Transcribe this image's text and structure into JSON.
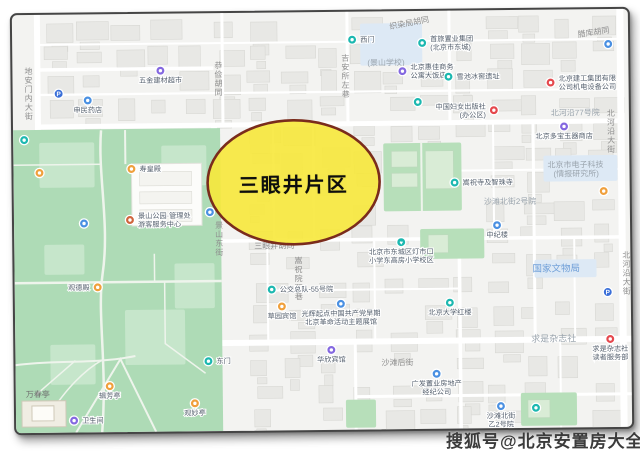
{
  "annotation": {
    "label": "三眼井片区"
  },
  "watermark": {
    "text": "搜狐号@北京安置房大全"
  },
  "colors": {
    "ellipse_fill": "#f7e83b",
    "ellipse_border": "#7a2c1c",
    "park": "#aedbb6",
    "lawn": "#c6e6cb",
    "zone_green": "#b7dfba",
    "zone_blue": "#dde9f5",
    "building": "#e8e8e5",
    "building_stroke": "#d8d8d4",
    "road": "#ffffff",
    "teal": "#1cb8b0",
    "blue": "#4a90e2",
    "purple": "#8468e0",
    "orange": "#f0a03c",
    "red": "#e5484d",
    "brown": "#d0643c",
    "parking": "#3a6fd8",
    "label_gray": "#8e8e8e",
    "label_zone": "#9aa4ad",
    "label_blue": "#6f9fd8",
    "label_park": "#6e6e6e",
    "poi_text": "#55606e"
  },
  "map": {
    "road_labels": [
      {
        "text": "地安门内大街",
        "x": 16,
        "y": 52,
        "vertical": true,
        "style": "gray"
      },
      {
        "text": "恭俭胡同",
        "x": 206,
        "y": 48,
        "vertical": true,
        "style": "gray"
      },
      {
        "text": "吉安所左巷",
        "x": 333,
        "y": 42,
        "vertical": true,
        "style": "gray"
      },
      {
        "text": "织染局胡同",
        "x": 378,
        "y": 18,
        "rotate": -10,
        "style": "gray"
      },
      {
        "text": "腊库胡同",
        "x": 566,
        "y": 28,
        "rotate": -8,
        "style": "gray"
      },
      {
        "text": "景山东街",
        "x": 205,
        "y": 208,
        "vertical": true,
        "style": "gray"
      },
      {
        "text": "三眼井胡同",
        "x": 240,
        "y": 236,
        "style": "gray"
      },
      {
        "text": "嵩祝院西巷",
        "x": 284,
        "y": 244,
        "vertical": true,
        "style": "gray"
      },
      {
        "text": "沙滩后街",
        "x": 366,
        "y": 354,
        "style": "gray"
      },
      {
        "text": "北河沿大街",
        "x": 598,
        "y": 100,
        "vertical": true,
        "style": "gray"
      },
      {
        "text": "北河沿大街",
        "x": 612,
        "y": 242,
        "vertical": true,
        "style": "gray"
      },
      {
        "text": "(景山学校)",
        "x": 355,
        "y": 54,
        "style": "zone"
      },
      {
        "text": "沙滩北街2号院",
        "x": 470,
        "y": 194,
        "style": "zone"
      },
      {
        "text": "北河沿77号院",
        "x": 538,
        "y": 106,
        "style": "zone"
      },
      {
        "text": "求是杂志社",
        "x": 516,
        "y": 332,
        "style": "zone",
        "size": 9
      },
      {
        "text": "北京市电子科技",
        "x": 534,
        "y": 158,
        "style": "zone"
      },
      {
        "text": "(情报研究所)",
        "x": 540,
        "y": 167,
        "style": "zone"
      },
      {
        "text": "国家文物局",
        "x": 518,
        "y": 262,
        "style": "blue",
        "size": 9.5
      },
      {
        "text": "万春亭",
        "x": 10,
        "y": 382,
        "style": "park"
      }
    ],
    "pois": [
      {
        "x": 148,
        "y": 57,
        "color": "purple",
        "lines": [
          "五金建材超市"
        ],
        "pos": "below"
      },
      {
        "x": 46,
        "y": 79,
        "color": "parking",
        "glyph": "P",
        "lines": [],
        "pos": "below"
      },
      {
        "x": 75,
        "y": 86,
        "color": "blue",
        "lines": [
          "申民药店"
        ],
        "pos": "below"
      },
      {
        "x": 340,
        "y": 28,
        "color": "teal",
        "lines": [
          "西门"
        ],
        "pos": "right"
      },
      {
        "x": 410,
        "y": 32,
        "color": "teal",
        "lines": [
          "首旅置业集团",
          "(北京市东城)"
        ],
        "pos": "right"
      },
      {
        "x": 596,
        "y": 35,
        "color": "blue",
        "lines": [],
        "pos": "below"
      },
      {
        "x": 390,
        "y": 60,
        "color": "purple",
        "lines": [
          "北京惠佳商务",
          "公寓大饭店"
        ],
        "pos": "right"
      },
      {
        "x": 436,
        "y": 66,
        "color": "teal",
        "lines": [
          "雪池冰窖遗址"
        ],
        "pos": "right"
      },
      {
        "x": 481,
        "y": 100,
        "color": "red",
        "lines": [
          "中国妇女出版社",
          "(办公区)"
        ],
        "pos": "left"
      },
      {
        "x": 538,
        "y": 73,
        "color": "red",
        "lines": [
          "北京建工集团有限",
          "公司机电设备公司"
        ],
        "pos": "right"
      },
      {
        "x": 551,
        "y": 117,
        "color": "purple",
        "lines": [
          "北京多宝玉器商店"
        ],
        "pos": "below"
      },
      {
        "x": 405,
        "y": 91,
        "color": "teal",
        "lines": [],
        "pos": "below"
      },
      {
        "x": 441,
        "y": 172,
        "color": "teal",
        "lines": [
          "嵩祝寺及智珠寺"
        ],
        "pos": "right"
      },
      {
        "x": 483,
        "y": 215,
        "color": "blue",
        "lines": [
          "中纪楼"
        ],
        "pos": "below"
      },
      {
        "x": 387,
        "y": 231,
        "color": "teal",
        "heart": true,
        "lines": [
          "北京市东城区灯市口",
          "小学东高房小学校区"
        ],
        "pos": "below"
      },
      {
        "x": 257,
        "y": 277,
        "color": "teal",
        "lines": [
          "公交总队-55号院"
        ],
        "pos": "right"
      },
      {
        "x": 267,
        "y": 294,
        "color": "orange",
        "lines": [
          "草园宾馆"
        ],
        "pos": "below"
      },
      {
        "x": 326,
        "y": 292,
        "color": "blue",
        "lines": [
          "光辉起点中国共产党早期",
          "北京革命活动主题展馆"
        ],
        "pos": "below"
      },
      {
        "x": 316,
        "y": 338,
        "color": "purple",
        "lines": [
          "华欣宾馆"
        ],
        "pos": "below"
      },
      {
        "x": 435,
        "y": 292,
        "color": "teal",
        "lines": [
          "北京大学红楼"
        ],
        "pos": "below"
      },
      {
        "x": 595,
        "y": 330,
        "color": "red",
        "lines": [
          "求是杂志社",
          "读者服务部"
        ],
        "pos": "below"
      },
      {
        "x": 593,
        "y": 283,
        "color": "parking",
        "glyph": "P",
        "lines": [],
        "pos": "below"
      },
      {
        "x": 421,
        "y": 363,
        "color": "blue",
        "lines": [
          "广发置业房地产",
          "经纪公司"
        ],
        "pos": "below"
      },
      {
        "x": 485,
        "y": 396,
        "color": "blue",
        "lines": [
          "沙滩北街",
          "乙2号院"
        ],
        "pos": "below"
      },
      {
        "x": 520,
        "y": 398,
        "color": "teal",
        "lines": [],
        "pos": "below"
      },
      {
        "x": 590,
        "y": 182,
        "color": "orange",
        "lines": [],
        "pos": "below"
      },
      {
        "x": 58,
        "y": 406,
        "color": "purple",
        "lines": [
          "卫生间"
        ],
        "pos": "right"
      },
      {
        "x": 94,
        "y": 372,
        "color": "orange",
        "lines": [
          "辑芳亭"
        ],
        "pos": "below"
      },
      {
        "x": 179,
        "y": 390,
        "color": "orange",
        "lines": [
          "观妙亭"
        ],
        "pos": "below"
      },
      {
        "x": 193,
        "y": 348,
        "color": "teal",
        "lines": [
          "东门"
        ],
        "pos": "right"
      },
      {
        "x": 83,
        "y": 273,
        "color": "orange",
        "lines": [
          "观德殿"
        ],
        "pos": "left"
      },
      {
        "x": 118,
        "y": 155,
        "color": "orange",
        "lines": [
          "寿皇殿"
        ],
        "pos": "right"
      },
      {
        "x": 116,
        "y": 206,
        "color": "brown",
        "lines": [
          "景山公园·管理处",
          "游客服务中心"
        ],
        "pos": "right"
      },
      {
        "x": 70,
        "y": 209,
        "color": "blue",
        "lines": [],
        "pos": "below"
      },
      {
        "x": 196,
        "y": 199,
        "color": "blue",
        "lines": [],
        "pos": "below"
      },
      {
        "x": 26,
        "y": 158,
        "color": "orange",
        "lines": [],
        "pos": "below"
      },
      {
        "x": 11,
        "y": 125,
        "color": "teal",
        "lines": [],
        "pos": "below"
      }
    ]
  }
}
